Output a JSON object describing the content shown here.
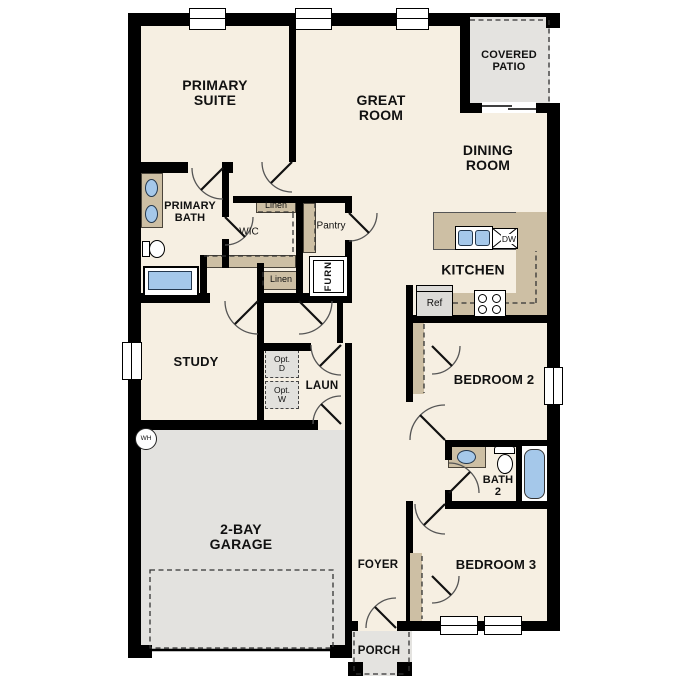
{
  "plan_title": "Single-story floor plan",
  "colors": {
    "floor": "#F6EFE2",
    "wall": "#000000",
    "counter_tan": "#CDBFA4",
    "garage_gray": "#E3E2DF",
    "patio_gray": "#E4E3E0",
    "fixture_blue": "#A5C8EA",
    "option_box": "#E2E1DD",
    "fridge_fill": "#DCDBD8"
  },
  "rooms": {
    "primary_suite": {
      "lines": [
        "PRIMARY",
        "SUITE"
      ]
    },
    "great_room": {
      "lines": [
        "GREAT",
        "ROOM"
      ]
    },
    "covered_patio": {
      "lines": [
        "COVERED",
        "PATIO"
      ]
    },
    "dining_room": {
      "lines": [
        "DINING",
        "ROOM"
      ]
    },
    "kitchen": {
      "label": "KITCHEN"
    },
    "primary_bath": {
      "lines": [
        "PRIMARY",
        "BATH"
      ]
    },
    "wic": {
      "label": "WIC"
    },
    "pantry": {
      "label": "Pantry"
    },
    "study": {
      "label": "STUDY"
    },
    "laundry": {
      "label": "LAUN"
    },
    "garage": {
      "lines": [
        "2-BAY",
        "GARAGE"
      ]
    },
    "bedroom2": {
      "label": "BEDROOM 2"
    },
    "bath2": {
      "lines": [
        "BATH",
        "2"
      ]
    },
    "bedroom3": {
      "label": "BEDROOM 3"
    },
    "foyer": {
      "label": "FOYER"
    },
    "porch": {
      "label": "PORCH"
    }
  },
  "fixtures": {
    "linen_top": "Linen",
    "linen_bottom": "Linen",
    "furnace": "FURN",
    "fridge": "Ref",
    "dishwasher": "DW",
    "water_heater": "WH",
    "opt_dryer": [
      "Opt.",
      "D"
    ],
    "opt_washer": [
      "Opt.",
      "W"
    ]
  }
}
